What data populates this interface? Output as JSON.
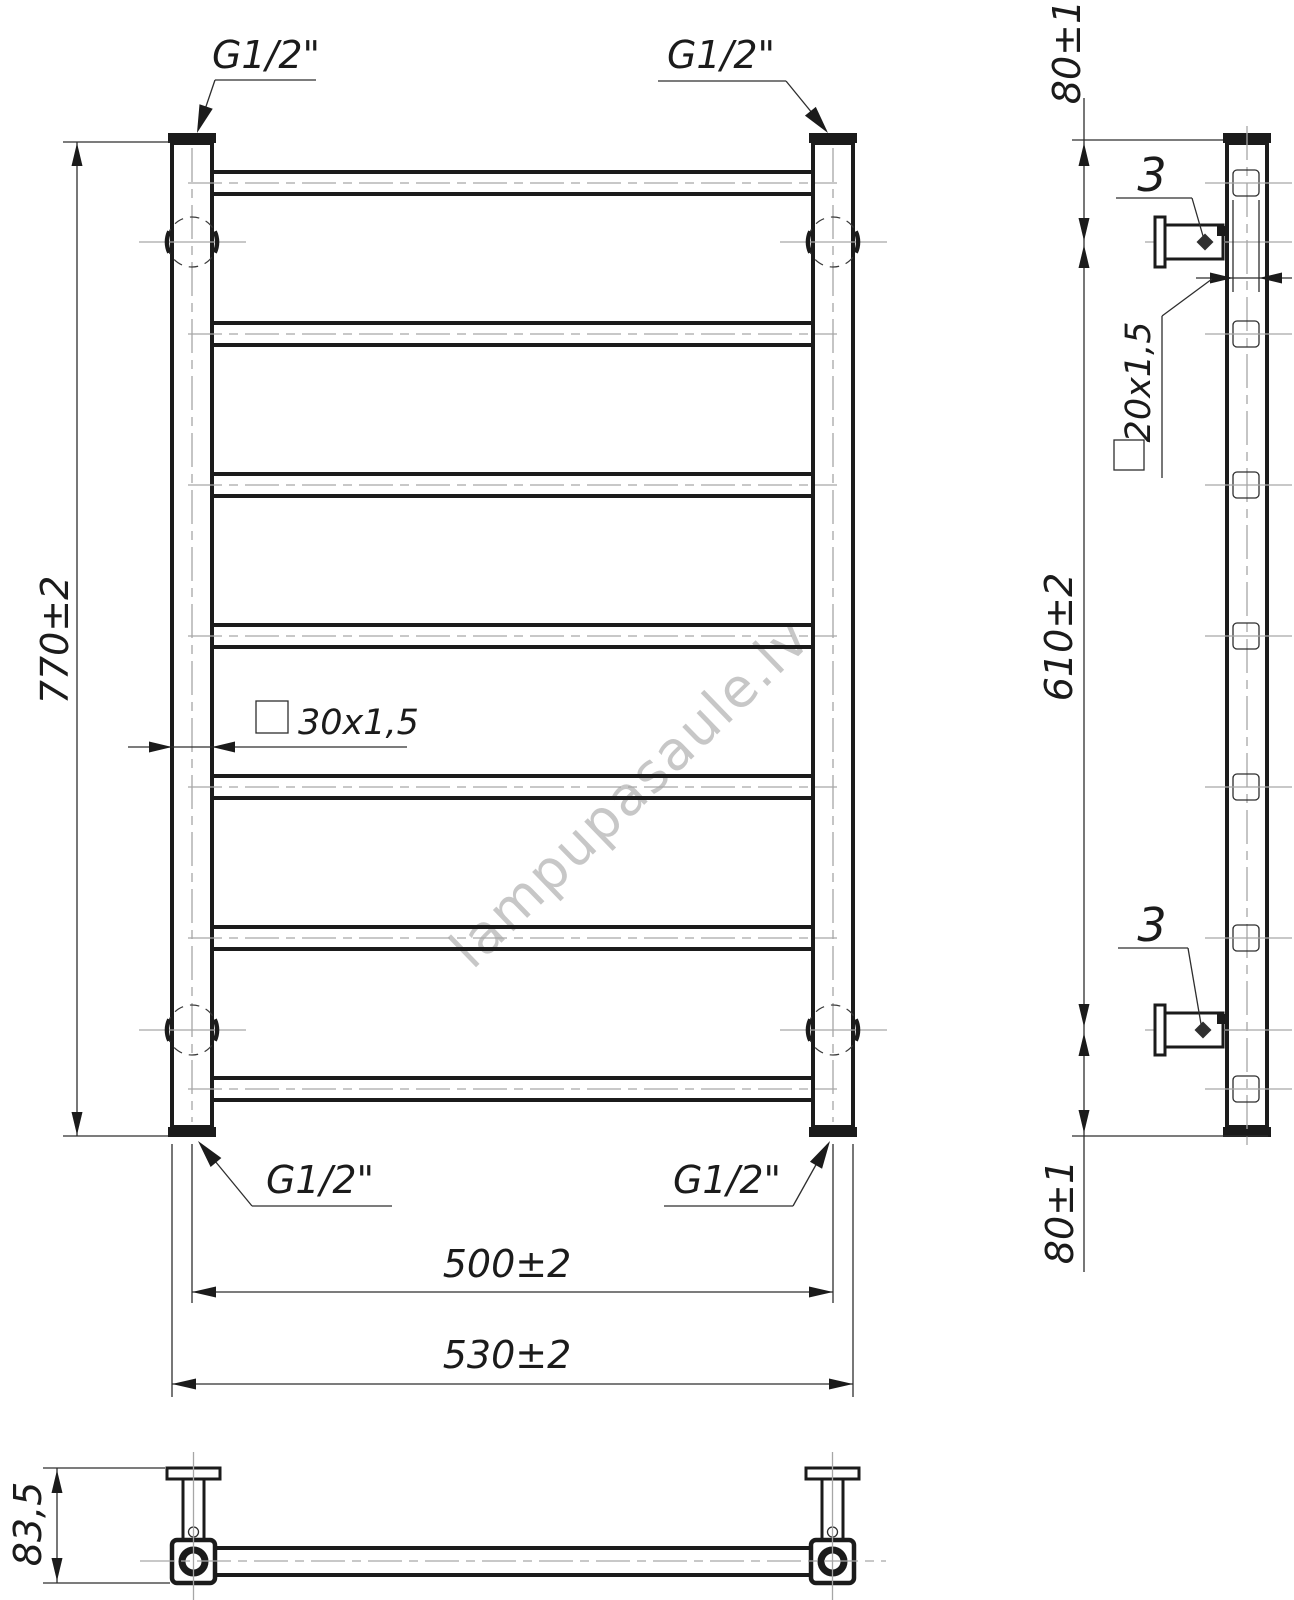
{
  "page": {
    "background": "#ffffff",
    "line_color": "#1b1b1b",
    "centerline_color": "#a6a6a6",
    "watermark_color": "#c7c7c7"
  },
  "watermark": {
    "text": "lampupasaule.lv"
  },
  "front_view": {
    "thread_label_top_left": "G1/2\"",
    "thread_label_top_right": "G1/2\"",
    "thread_label_bottom_left": "G1/2\"",
    "thread_label_bottom_right": "G1/2\"",
    "height_dim": "770±2",
    "collector_section_dim": "30x1,5",
    "axis_width_dim": "500±2",
    "overall_width_dim": "530±2"
  },
  "side_view": {
    "top_offset_dim": "80±1",
    "bracket_span_dim": "610±2",
    "bottom_offset_dim": "80±1",
    "rung_section_dim": "20x1,5",
    "screw_label_top": "3",
    "screw_label_bottom": "3"
  },
  "bottom_view": {
    "depth_dim": "83,5"
  }
}
